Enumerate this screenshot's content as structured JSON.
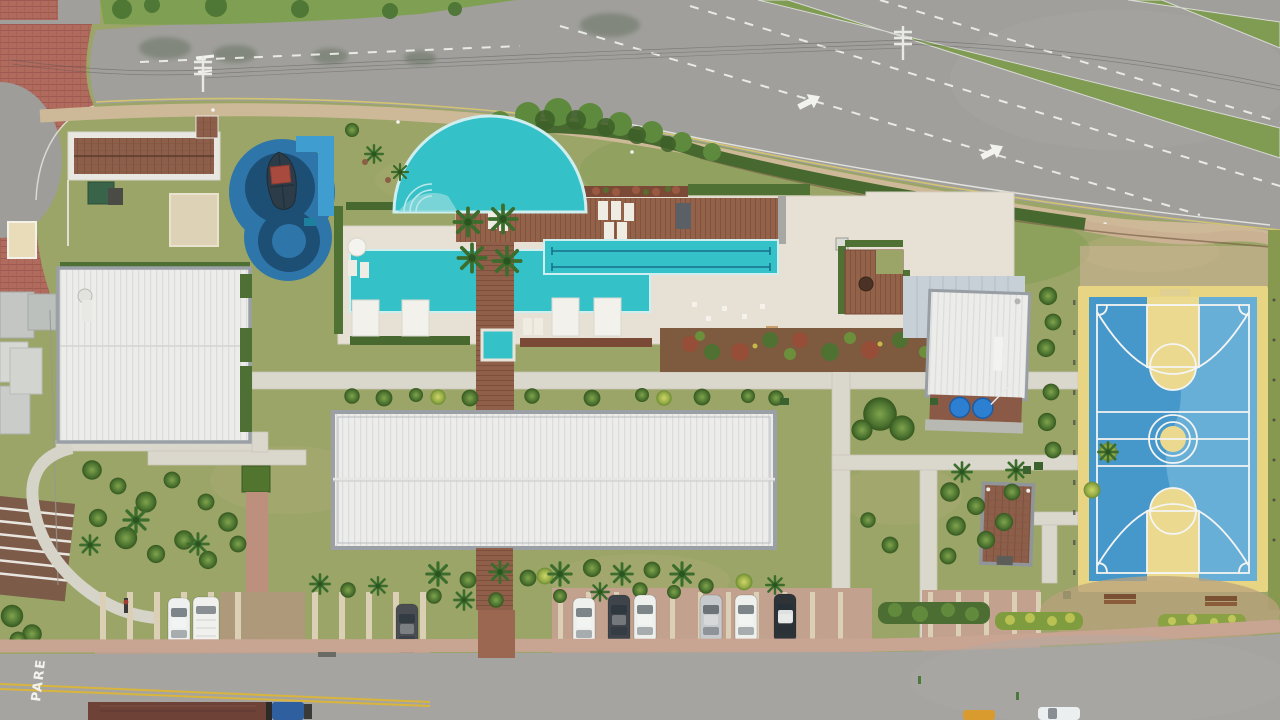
{
  "scene": {
    "type": "aerial-drone-photo",
    "subject": "condominium leisure area with pools, clubhouse, sports court and parking",
    "view": "top-down"
  },
  "road_markings": {
    "stop_text": "PARE",
    "lane_arrow_count": 2,
    "lane_line_style": "white-dashed",
    "center_line_style": "double-yellow"
  },
  "areas": {
    "circular_pool": "circular pool with beach entry",
    "lap_pool": "two-lane lap pool",
    "kids_playground": "blue aquatic playground with pirate-ship structure",
    "sports_court": "blue and yellow basketball court",
    "clubhouse": "clubhouse with brown tiled roof",
    "main_hall": "large white-roofed multi-sport hall",
    "left_hall": "white-roofed gym building",
    "support_building": "support building with water tanks",
    "small_building": "small brown-roofed kiosk",
    "parking": "paver parking stalls",
    "avenue": "curved avenue at top",
    "service_road": "access road at bottom"
  },
  "counts": {
    "parked_cars_middle_lot": 6,
    "parked_cars_left_lot": 3,
    "benches": 2,
    "water_tanks": 2,
    "pool_cabanas": 4
  },
  "colors": {
    "lawn": "#9aa567",
    "lawn_dark": "#7f9c52",
    "asphalt": "#a09f9c",
    "asphalt2": "#a5a4a1",
    "pool": "#35c1c8",
    "pool_edge": "#cfeef0",
    "kids_blue": "#2e76aa",
    "kids_dark": "#1d4e74",
    "kids_light": "#3f9ecf",
    "court_blue": "#4698cb",
    "court_blue_light": "#6fb3da",
    "court_yellow": "#e7d584",
    "deck_wood": "#936249",
    "paver_red": "#b06a5e",
    "path_concrete": "#dad7cd",
    "sidewalk_pink": "#c8a492",
    "tan_path": "#cdb997",
    "roof_white": "#ececeb",
    "roof_brown": "#8d5e49",
    "hedge_green": "#4f7134",
    "line_white": "#f2f2ef",
    "line_yellow": "#d8c86a"
  }
}
